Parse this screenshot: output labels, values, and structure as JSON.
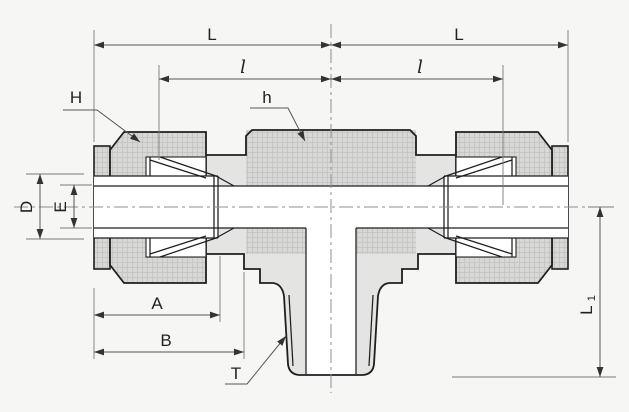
{
  "drawing": {
    "labels": {
      "L_left": "L",
      "L_right": "L",
      "l_left": "l",
      "l_right": "l",
      "H": "H",
      "h": "h",
      "D": "D",
      "E": "E",
      "A": "A",
      "B": "B",
      "T": "T",
      "L1_main": "L",
      "L1_sub": "1"
    },
    "colors": {
      "background": "#f6f6f4",
      "metal_fill": "#e4e4e2",
      "knurl_fill": "#d8d8d6",
      "knurl_line": "#c2c2bf",
      "outline": "#1f1f1f",
      "dimension_line": "#555555",
      "extension_line": "#7a7a7a",
      "centerline": "#8f8f8f",
      "label_text": "#222222",
      "section_white": "#ffffff"
    }
  }
}
